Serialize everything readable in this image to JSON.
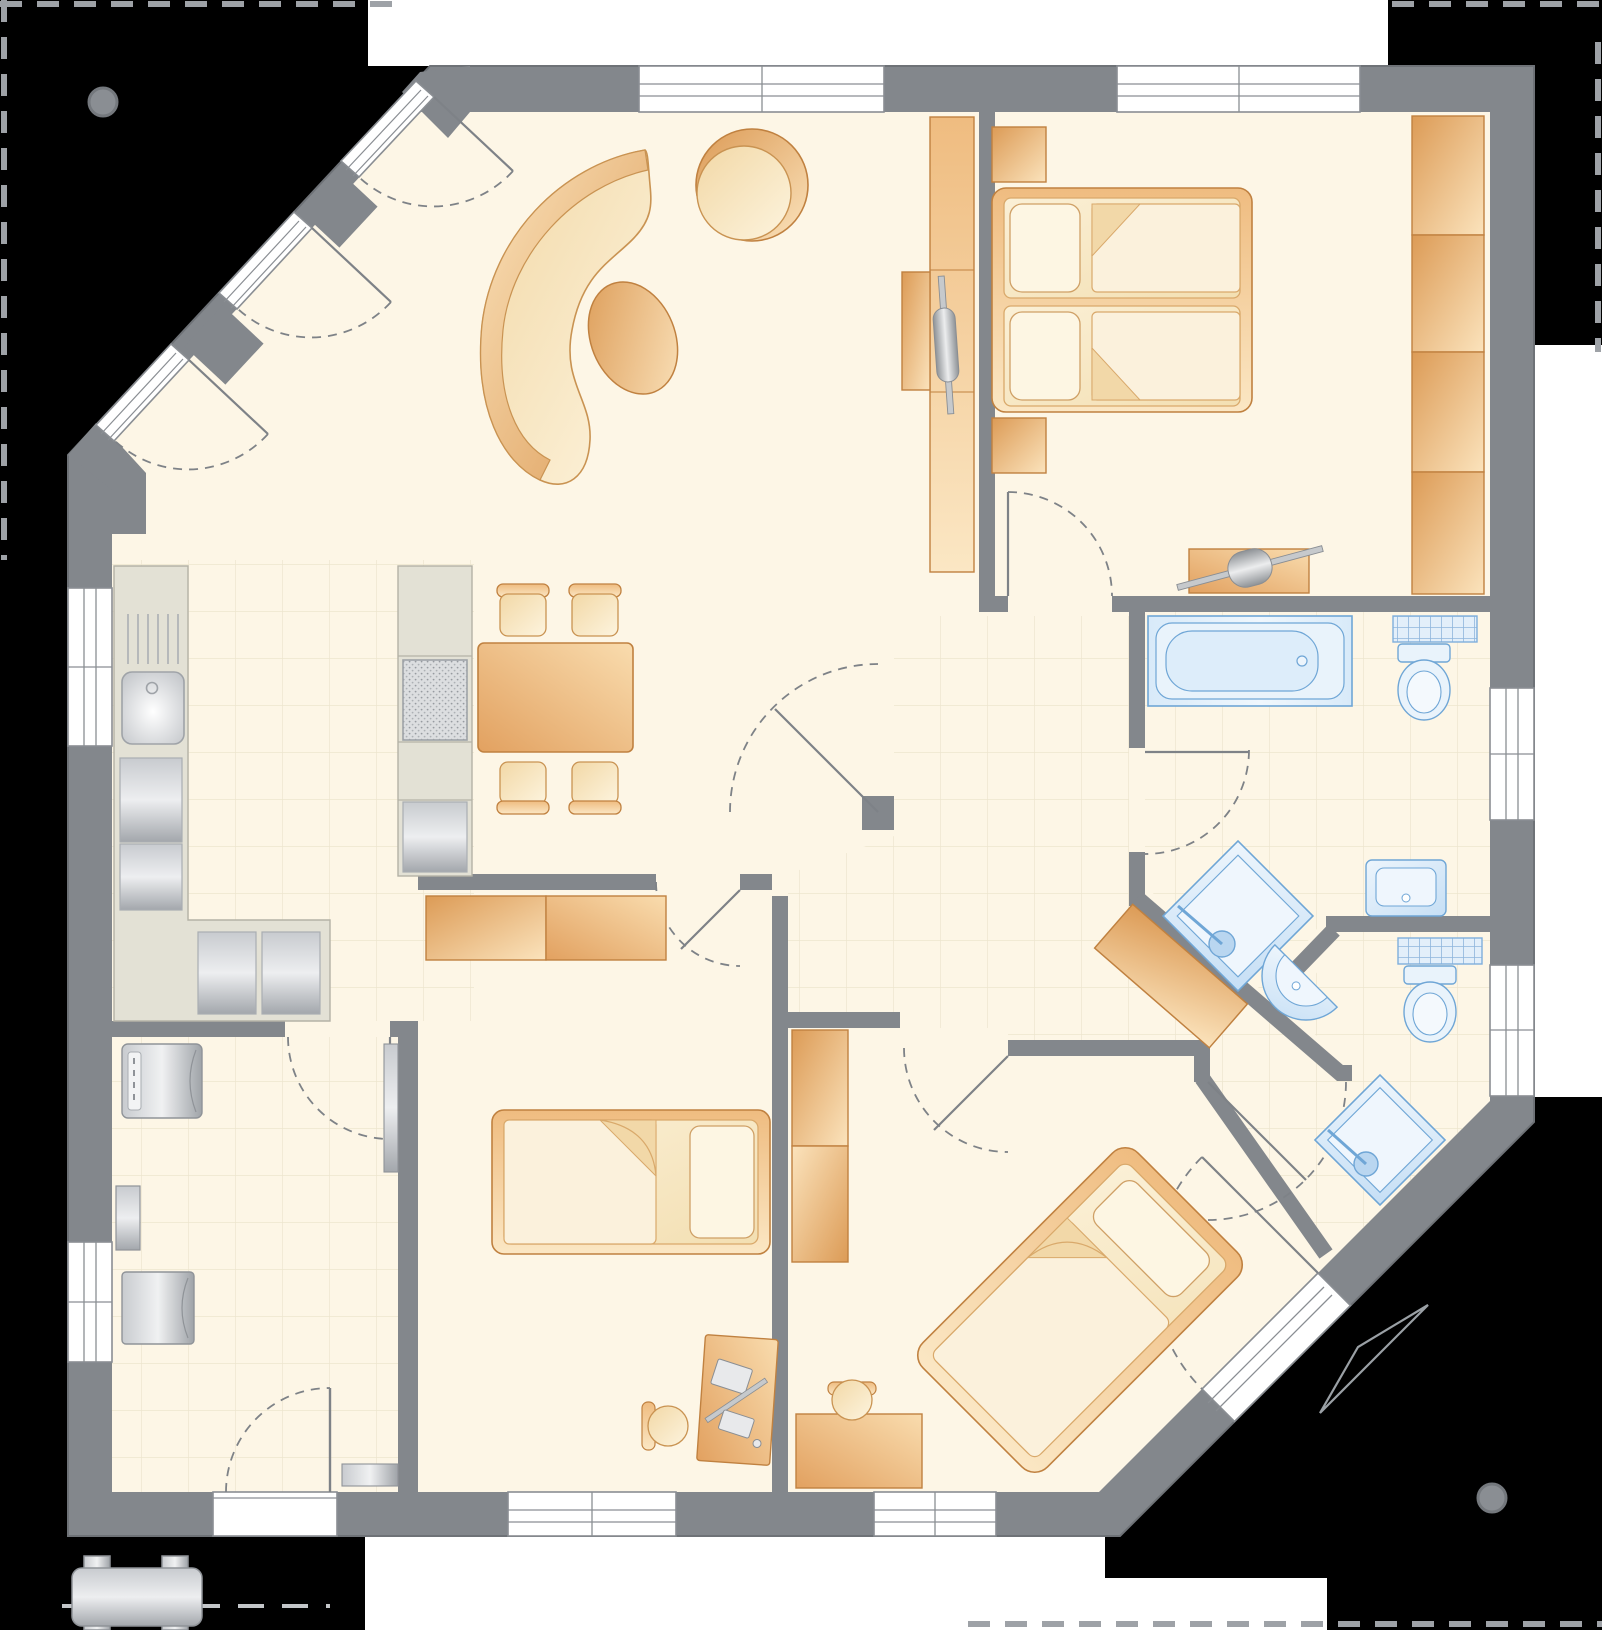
{
  "meta": {
    "title": "single-storey-house-floor-plan",
    "canvas_width": 1602,
    "canvas_height": 1630
  },
  "colors": {
    "background": "#000000",
    "paper": "#FFFFFF",
    "wall": "#83878C",
    "wall_edge": "#6E7277",
    "floor": "#FDF6E6",
    "tile_line": "#EDE5CE",
    "window_frame": "#8A8E93",
    "door_line": "#7E8287",
    "furniture_border": "#C08140",
    "orange_dark": "#DC9B56",
    "orange_mid": "#F2BE83",
    "orange_light": "#FBE3BC",
    "cream_dark": "#F2D8A6",
    "cream_light": "#FDF4DE",
    "mattress_light": "#FBF0D6",
    "mattress_dark": "#F3DFB2",
    "mattress_border": "#D9A96B",
    "fixture_border": "#6FA6D6",
    "fixture_fill_light": "#EDF5FC",
    "fixture_fill": "#C6DFF5",
    "appliance_dark": "#9EA2A7",
    "appliance_light": "#EDEEF0",
    "counter_fill": "#E3E1D5",
    "counter_border": "#B4B2A6",
    "boundary_dash": "#9EA2A7",
    "survey_marker": "#8A8E93"
  },
  "site": {
    "boundary_markers": 2,
    "north_arrow": true,
    "underground_tank": true
  },
  "openings": {
    "windows_count": 8,
    "exterior_doors": [
      "entrance-door",
      "terrace-door",
      "patio-door-1",
      "patio-door-2",
      "patio-door-3"
    ],
    "interior_doors_count": 7
  },
  "rooms": [
    {
      "id": "living-dining",
      "floor": "plain",
      "furniture": [
        "curved-sofa",
        "round-armchair",
        "oval-ottoman",
        "dining-table",
        "dining-stool",
        "dining-stool",
        "dining-stool",
        "dining-stool",
        "tv-wall-unit",
        "tv"
      ]
    },
    {
      "id": "kitchen",
      "floor": "tiled",
      "furniture": [
        "counter-run",
        "kitchen-sink",
        "drainboard",
        "built-in-fridge",
        "corner-base-cabinets",
        "tall-cabinet-line",
        "cooktop",
        "oven"
      ]
    },
    {
      "id": "master-bedroom",
      "floor": "plain",
      "furniture": [
        "double-bed",
        "pillow",
        "pillow",
        "nightstand",
        "nightstand",
        "wardrobe-four-sections",
        "dresser",
        "tv"
      ]
    },
    {
      "id": "bathroom",
      "floor": "tiled",
      "fixtures": [
        "bathtub",
        "toilet",
        "towel-radiator",
        "washbasin",
        "corner-shower"
      ]
    },
    {
      "id": "shower-wc",
      "floor": "tiled",
      "fixtures": [
        "corner-shower",
        "semicircle-washbasin",
        "toilet",
        "towel-radiator"
      ]
    },
    {
      "id": "child-room",
      "floor": "plain",
      "furniture": [
        "single-bed",
        "sideboard",
        "sideboard",
        "desk",
        "computer",
        "desk-stool"
      ]
    },
    {
      "id": "guest-bedroom",
      "floor": "plain",
      "furniture": [
        "diagonal-bed",
        "wardrobe-two-sections",
        "desk",
        "round-stool"
      ]
    },
    {
      "id": "utility-room",
      "floor": "tiled",
      "fixtures": [
        "washing-machine",
        "water-heater",
        "chest-freezer",
        "radiator",
        "entrance-door"
      ]
    },
    {
      "id": "hallway",
      "floor": "tiled",
      "furniture": [
        "diagonal-sideboard"
      ]
    }
  ]
}
